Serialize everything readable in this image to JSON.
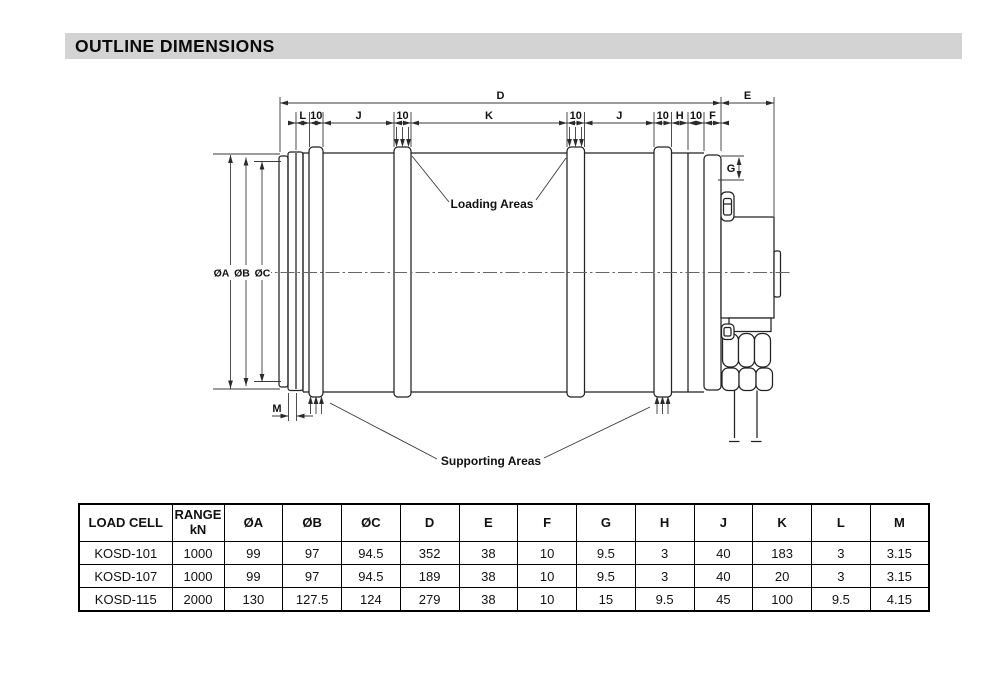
{
  "header": {
    "title": "OUTLINE DIMENSIONS"
  },
  "drawing": {
    "labels": {
      "d": "D",
      "e": "E",
      "l": "L",
      "ten": "10",
      "j": "J",
      "k": "K",
      "h": "H",
      "f": "F",
      "g": "G",
      "m": "M",
      "dia_a": "ØA",
      "dia_b": "ØB",
      "dia_c": "ØC",
      "loading_areas": "Loading Areas",
      "supporting_areas": "Supporting Areas"
    }
  },
  "table": {
    "header": {
      "load_cell": "LOAD CELL",
      "range_line1": "RANGE",
      "range_line2": "kN",
      "dims": [
        "ØA",
        "ØB",
        "ØC",
        "D",
        "E",
        "F",
        "G",
        "H",
        "J",
        "K",
        "L",
        "M"
      ]
    },
    "rows": [
      {
        "model": "KOSD-101",
        "range": "1000",
        "values": [
          "99",
          "97",
          "94.5",
          "352",
          "38",
          "10",
          "9.5",
          "3",
          "40",
          "183",
          "3",
          "3.15"
        ]
      },
      {
        "model": "KOSD-107",
        "range": "1000",
        "values": [
          "99",
          "97",
          "94.5",
          "189",
          "38",
          "10",
          "9.5",
          "3",
          "40",
          "20",
          "3",
          "3.15"
        ]
      },
      {
        "model": "KOSD-115",
        "range": "2000",
        "values": [
          "130",
          "127.5",
          "124",
          "279",
          "38",
          "10",
          "15",
          "9.5",
          "45",
          "100",
          "9.5",
          "4.15"
        ]
      }
    ]
  }
}
